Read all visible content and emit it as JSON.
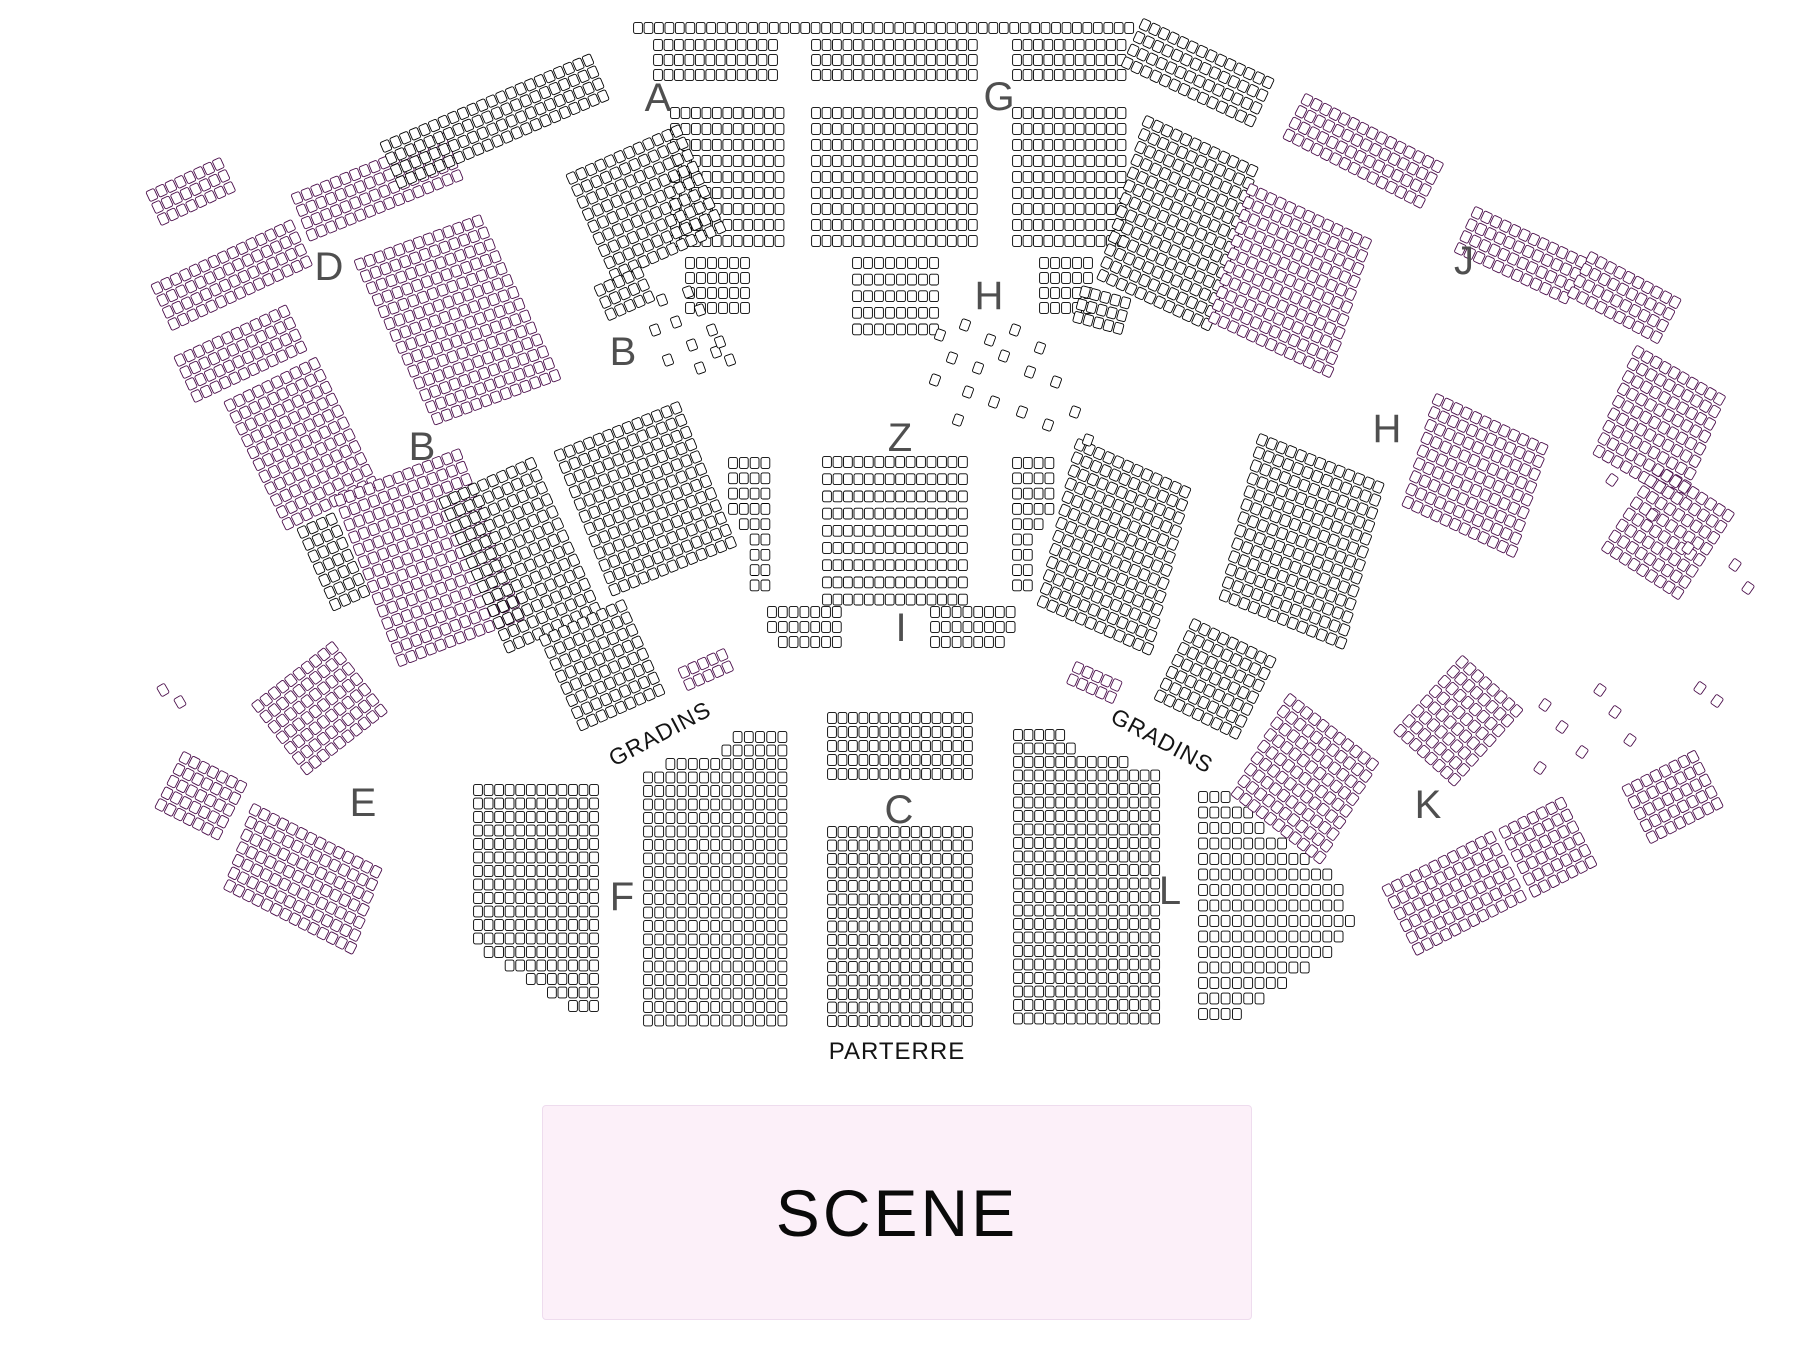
{
  "map": {
    "title": "Seating plan",
    "colors": {
      "background": "#ffffff",
      "seat_fill": "#ffffff",
      "seat_stroke": "#000000",
      "seat_stroke_alt": "#4a0d4a",
      "section_label": "#4f4f4f",
      "text": "#141414",
      "stage_bg": "#fcf0f9",
      "stage_border": "#eedcee"
    },
    "seat": {
      "w": 8.8,
      "h": 10.8,
      "rx": 1.8
    },
    "texts": {
      "gradins_left": "GRADINS",
      "gradins_right": "GRADINS",
      "parterre": "PARTERRE"
    },
    "stage": {
      "label": "SCENE"
    },
    "sections": [
      {
        "t": "A",
        "x": 658,
        "y": 98
      },
      {
        "t": "G",
        "x": 999,
        "y": 97
      },
      {
        "t": "D",
        "x": 329,
        "y": 267
      },
      {
        "t": "B",
        "x": 623,
        "y": 352
      },
      {
        "t": "B",
        "x": 422,
        "y": 447
      },
      {
        "t": "H",
        "x": 989,
        "y": 296
      },
      {
        "t": "J",
        "x": 1464,
        "y": 261
      },
      {
        "t": "H",
        "x": 1387,
        "y": 429
      },
      {
        "t": "Z",
        "x": 900,
        "y": 438
      },
      {
        "t": "I",
        "x": 901,
        "y": 628
      },
      {
        "t": "E",
        "x": 363,
        "y": 803
      },
      {
        "t": "K",
        "x": 1428,
        "y": 805
      },
      {
        "t": "F",
        "x": 622,
        "y": 897
      },
      {
        "t": "C",
        "x": 899,
        "y": 810
      },
      {
        "t": "L",
        "x": 1170,
        "y": 891
      }
    ],
    "blocks": [
      {
        "n": "top-row",
        "x": 638,
        "y": 28,
        "c": 48,
        "r": 1,
        "rp": 16
      },
      {
        "n": "upper-left",
        "x": 658,
        "y": 45,
        "c": 12,
        "r": 3,
        "rp": 15
      },
      {
        "n": "upper-center",
        "x": 816,
        "y": 45,
        "c": 16,
        "r": 3,
        "rp": 15
      },
      {
        "n": "upper-right",
        "x": 1017,
        "y": 45,
        "c": 11,
        "r": 3,
        "rp": 15
      },
      {
        "n": "A-main",
        "x": 675,
        "y": 113,
        "c": 11,
        "r": 9,
        "rp": 16
      },
      {
        "n": "G-main",
        "x": 816,
        "y": 113,
        "c": 16,
        "r": 9,
        "rp": 16
      },
      {
        "n": "G-right",
        "x": 1017,
        "y": 113,
        "c": 11,
        "r": 9,
        "rp": 16
      },
      {
        "n": "H-center",
        "x": 857,
        "y": 263,
        "c": 8,
        "r": 5,
        "rp": 16.6,
        "cp": 11
      },
      {
        "n": "H-left-tail",
        "x": 690,
        "y": 263,
        "c": 6,
        "r": 4,
        "rp": 15,
        "cp": 11
      },
      {
        "n": "H-right-tail",
        "x": 1044,
        "y": 263,
        "c": 5,
        "r": 4,
        "rp": 15,
        "cp": 11
      },
      {
        "n": "Z-main",
        "x": 827,
        "y": 462,
        "c": 14,
        "r": 9,
        "rp": 17.2
      },
      {
        "n": "Z-left-flank",
        "x": 733,
        "y": 463,
        "rp": 15.3,
        "cp": 10.8,
        "spec": [
          [
            0,
            4
          ],
          [
            0,
            4
          ],
          [
            0,
            4
          ],
          [
            0,
            4
          ],
          [
            1,
            3
          ],
          [
            2,
            2
          ],
          [
            2,
            2
          ],
          [
            2,
            2
          ],
          [
            2,
            2
          ]
        ]
      },
      {
        "n": "Z-right-flank",
        "x": 1017,
        "y": 463,
        "rp": 15.3,
        "cp": 10.8,
        "spec": [
          [
            0,
            4
          ],
          [
            0,
            4
          ],
          [
            0,
            4
          ],
          [
            0,
            4
          ],
          [
            0,
            3
          ],
          [
            0,
            2
          ],
          [
            0,
            2
          ],
          [
            0,
            2
          ],
          [
            0,
            2
          ]
        ]
      },
      {
        "n": "I-left",
        "x": 772,
        "y": 612,
        "rp": 15,
        "cp": 10.8,
        "spec": [
          [
            0,
            7
          ],
          [
            0,
            7
          ],
          [
            1,
            6
          ]
        ]
      },
      {
        "n": "I-right",
        "x": 935,
        "y": 612,
        "rp": 15,
        "cp": 10.8,
        "spec": [
          [
            0,
            8
          ],
          [
            0,
            8
          ],
          [
            0,
            7
          ]
        ]
      },
      {
        "n": "C-upper",
        "x": 832,
        "y": 718,
        "c": 14,
        "r": 5,
        "rp": 14
      },
      {
        "n": "C-lower",
        "x": 832,
        "y": 832,
        "c": 14,
        "r": 15,
        "rp": 13.5
      },
      {
        "n": "F-main",
        "x": 648,
        "y": 737,
        "cp": 11.2,
        "rp": 13.5,
        "spec": [
          [
            8,
            5
          ],
          [
            7,
            6
          ],
          [
            2,
            11
          ],
          [
            0,
            13
          ],
          [
            0,
            13
          ],
          [
            0,
            13
          ],
          [
            0,
            13
          ],
          [
            0,
            13
          ],
          [
            0,
            13
          ],
          [
            0,
            13
          ],
          [
            0,
            13
          ],
          [
            0,
            13
          ],
          [
            0,
            13
          ],
          [
            0,
            13
          ],
          [
            0,
            13
          ],
          [
            0,
            13
          ],
          [
            0,
            13
          ],
          [
            0,
            13
          ],
          [
            0,
            13
          ],
          [
            0,
            13
          ],
          [
            0,
            13
          ],
          [
            0,
            13
          ]
        ]
      },
      {
        "n": "L-main",
        "x": 1018,
        "y": 735,
        "cp": 10.55,
        "rp": 13.5,
        "spec": [
          [
            0,
            5
          ],
          [
            0,
            6
          ],
          [
            0,
            11
          ],
          [
            0,
            14
          ],
          [
            0,
            14
          ],
          [
            0,
            14
          ],
          [
            0,
            14
          ],
          [
            0,
            14
          ],
          [
            0,
            14
          ],
          [
            0,
            14
          ],
          [
            0,
            14
          ],
          [
            0,
            14
          ],
          [
            0,
            14
          ],
          [
            0,
            14
          ],
          [
            0,
            14
          ],
          [
            0,
            14
          ],
          [
            0,
            14
          ],
          [
            0,
            14
          ],
          [
            0,
            14
          ],
          [
            0,
            14
          ],
          [
            0,
            14
          ],
          [
            0,
            14
          ]
        ]
      },
      {
        "n": "F-outer",
        "x": 478,
        "y": 790,
        "cp": 10.55,
        "rp": 13.5,
        "spec": [
          [
            0,
            12
          ],
          [
            0,
            12
          ],
          [
            0,
            12
          ],
          [
            0,
            12
          ],
          [
            0,
            12
          ],
          [
            0,
            12
          ],
          [
            0,
            12
          ],
          [
            0,
            12
          ],
          [
            0,
            12
          ],
          [
            0,
            12
          ],
          [
            0,
            12
          ],
          [
            0,
            12
          ],
          [
            1,
            11
          ],
          [
            3,
            9
          ],
          [
            5,
            7
          ],
          [
            7,
            5
          ],
          [
            9,
            3
          ]
        ]
      },
      {
        "n": "L-diamond",
        "x": 1203,
        "y": 797,
        "cp": 11.3,
        "rp": 15.5,
        "lens": [
          3,
          5,
          6,
          8,
          10,
          12,
          13,
          13,
          14,
          13,
          12,
          10,
          8,
          6,
          4
        ]
      },
      {
        "n": "dm",
        "x": 152,
        "y": 195,
        "rot": -25,
        "c": 8,
        "r": 3,
        "tint": "p"
      },
      {
        "n": "d1",
        "x": 157,
        "y": 288,
        "rot": -25,
        "c": 15,
        "r": 4,
        "tint": "p"
      },
      {
        "n": "d2",
        "x": 297,
        "y": 198,
        "rot": -22,
        "c": 16,
        "r": 4,
        "tint": "p"
      },
      {
        "n": "d4",
        "x": 180,
        "y": 360,
        "rot": -25,
        "c": 12,
        "r": 4,
        "tint": "p"
      },
      {
        "n": "d5",
        "x": 230,
        "y": 405,
        "rot": -26,
        "c": 10,
        "r": 11,
        "tint": "p"
      },
      {
        "n": "d3",
        "x": 360,
        "y": 264,
        "rot": -20,
        "c": 13,
        "r": 14,
        "sh": 1.5,
        "tint": "p"
      },
      {
        "n": "a1",
        "x": 386,
        "y": 146,
        "rot": -23,
        "c": 22,
        "r": 4,
        "rp": 13
      },
      {
        "n": "a2",
        "x": 572,
        "y": 178,
        "rot": -24,
        "c": 12,
        "r": 9
      },
      {
        "n": "a3",
        "x": 600,
        "y": 290,
        "rot": -24,
        "c": 5,
        "r": 3
      },
      {
        "n": "ar3",
        "x": 1085,
        "y": 292,
        "rot": 15,
        "c": 5,
        "r": 3
      },
      {
        "n": "b1",
        "x": 340,
        "y": 500,
        "rot": -21,
        "c": 13,
        "r": 14,
        "tint": "p"
      },
      {
        "n": "b-mid",
        "x": 560,
        "y": 455,
        "rot": -22,
        "c": 13,
        "r": 12
      },
      {
        "n": "be1",
        "x": 445,
        "y": 502,
        "rot": -24,
        "c": 10,
        "r": 13
      },
      {
        "n": "be2",
        "x": 303,
        "y": 532,
        "rot": -24,
        "c": 4,
        "r": 7
      },
      {
        "n": "b2",
        "x": 258,
        "y": 706,
        "rot": -38,
        "c": 10,
        "r": 7,
        "tint": "p"
      },
      {
        "n": "gl",
        "x": 545,
        "y": 640,
        "rot": -24,
        "c": 9,
        "r": 8
      },
      {
        "n": "glt",
        "x": 684,
        "y": 672,
        "rot": -24,
        "c": 5,
        "r": 2,
        "tint": "p"
      },
      {
        "n": "grt",
        "x": 1078,
        "y": 668,
        "rot": 24,
        "c": 5,
        "r": 2,
        "tint": "p"
      },
      {
        "n": "e1",
        "x": 185,
        "y": 758,
        "rot": 27,
        "c": 7,
        "r": 5,
        "tint": "p"
      },
      {
        "n": "e2",
        "x": 255,
        "y": 810,
        "rot": 27,
        "c": 14,
        "r": 7,
        "sh": 2,
        "tint": "p"
      },
      {
        "n": "lr1",
        "x": 1080,
        "y": 445,
        "rot": 24,
        "c": 12,
        "r": 13,
        "sh": 2.5
      },
      {
        "n": "gr",
        "x": 1195,
        "y": 625,
        "rot": 26,
        "c": 9,
        "r": 7
      },
      {
        "n": "ja",
        "x": 1145,
        "y": 25,
        "rot": 25,
        "c": 14,
        "r": 4,
        "rp": 14
      },
      {
        "n": "jm1",
        "x": 1148,
        "y": 122,
        "rot": 25,
        "c": 12,
        "r": 13,
        "sh": 2
      },
      {
        "n": "jm2",
        "x": 1252,
        "y": 190,
        "rot": 25,
        "c": 13,
        "r": 11,
        "sh": 2,
        "tint": "p"
      },
      {
        "n": "j1",
        "x": 1307,
        "y": 100,
        "rot": 27,
        "c": 15,
        "r": 4,
        "tint": "p"
      },
      {
        "n": "j2",
        "x": 1477,
        "y": 213,
        "rot": 25,
        "c": 12,
        "r": 4,
        "tint": "p"
      },
      {
        "n": "j3",
        "x": 1592,
        "y": 258,
        "rot": 28,
        "c": 10,
        "r": 4,
        "tint": "p"
      },
      {
        "n": "fr1",
        "x": 1638,
        "y": 352,
        "rot": 30,
        "c": 10,
        "r": 9,
        "sh": 2,
        "tint": "p"
      },
      {
        "n": "fr2",
        "x": 1658,
        "y": 470,
        "rot": 33,
        "c": 9,
        "r": 8,
        "tint": "p"
      },
      {
        "n": "hr1",
        "x": 1262,
        "y": 440,
        "rot": 22,
        "c": 13,
        "r": 13,
        "sh": 2
      },
      {
        "n": "hr2",
        "x": 1438,
        "y": 400,
        "rot": 25,
        "c": 12,
        "r": 9,
        "sh": 2,
        "tint": "p"
      },
      {
        "n": "kr-mid",
        "x": 1290,
        "y": 700,
        "rot": 38,
        "c": 11,
        "r": 9,
        "sh": 2,
        "tint": "p"
      },
      {
        "n": "k-fan",
        "x": 1462,
        "y": 662,
        "rot": 42,
        "c": 8,
        "r": 8,
        "tint": "p"
      },
      {
        "n": "k2a",
        "x": 1388,
        "y": 890,
        "rot": -27,
        "c": 12,
        "r": 6,
        "tint": "p"
      },
      {
        "n": "k2b",
        "x": 1505,
        "y": 832,
        "rot": -27,
        "c": 7,
        "r": 6,
        "tint": "p"
      },
      {
        "n": "k1o",
        "x": 1628,
        "y": 790,
        "rot": -27,
        "c": 8,
        "r": 5,
        "tint": "p"
      }
    ],
    "scatter": [
      {
        "x": 662,
        "y": 300,
        "rot": -20
      },
      {
        "x": 688,
        "y": 292,
        "rot": -20
      },
      {
        "x": 700,
        "y": 310,
        "rot": -20
      },
      {
        "x": 676,
        "y": 322,
        "rot": -20
      },
      {
        "x": 712,
        "y": 330,
        "rot": -20
      },
      {
        "x": 692,
        "y": 345,
        "rot": -20
      },
      {
        "x": 716,
        "y": 352,
        "rot": -20
      },
      {
        "x": 668,
        "y": 360,
        "rot": -20
      },
      {
        "x": 700,
        "y": 368,
        "rot": -20
      },
      {
        "x": 720,
        "y": 342,
        "rot": -20
      },
      {
        "x": 655,
        "y": 330,
        "rot": -20
      },
      {
        "x": 730,
        "y": 360,
        "rot": -20
      },
      {
        "x": 940,
        "y": 335,
        "rot": 20
      },
      {
        "x": 965,
        "y": 325,
        "rot": 20
      },
      {
        "x": 990,
        "y": 340,
        "rot": 20
      },
      {
        "x": 1015,
        "y": 330,
        "rot": 20
      },
      {
        "x": 1040,
        "y": 348,
        "rot": 20
      },
      {
        "x": 952,
        "y": 358,
        "rot": 20
      },
      {
        "x": 978,
        "y": 368,
        "rot": 20
      },
      {
        "x": 1004,
        "y": 356,
        "rot": 20
      },
      {
        "x": 1030,
        "y": 372,
        "rot": 20
      },
      {
        "x": 1056,
        "y": 382,
        "rot": 20
      },
      {
        "x": 968,
        "y": 392,
        "rot": 20
      },
      {
        "x": 994,
        "y": 402,
        "rot": 20
      },
      {
        "x": 1022,
        "y": 412,
        "rot": 20
      },
      {
        "x": 1048,
        "y": 425,
        "rot": 20
      },
      {
        "x": 1075,
        "y": 412,
        "rot": 20
      },
      {
        "x": 1088,
        "y": 440,
        "rot": 20
      },
      {
        "x": 958,
        "y": 420,
        "rot": 20
      },
      {
        "x": 935,
        "y": 380,
        "rot": 20
      },
      {
        "x": 1545,
        "y": 705,
        "rot": 35,
        "t": "p"
      },
      {
        "x": 1562,
        "y": 727,
        "rot": 35,
        "t": "p"
      },
      {
        "x": 1582,
        "y": 752,
        "rot": 35,
        "t": "p"
      },
      {
        "x": 1540,
        "y": 768,
        "rot": 35,
        "t": "p"
      },
      {
        "x": 1600,
        "y": 690,
        "rot": 35,
        "t": "p"
      },
      {
        "x": 1615,
        "y": 712,
        "rot": 35,
        "t": "p"
      },
      {
        "x": 1630,
        "y": 740,
        "rot": 35,
        "t": "p"
      },
      {
        "x": 1700,
        "y": 688,
        "rot": 35,
        "t": "p"
      },
      {
        "x": 1717,
        "y": 701,
        "rot": 35,
        "t": "p"
      },
      {
        "x": 1735,
        "y": 565,
        "rot": 35,
        "t": "p"
      },
      {
        "x": 1748,
        "y": 588,
        "rot": 35,
        "t": "p"
      },
      {
        "x": 1612,
        "y": 480,
        "rot": 35,
        "t": "p"
      },
      {
        "x": 1652,
        "y": 515,
        "rot": 35,
        "t": "p"
      },
      {
        "x": 1688,
        "y": 548,
        "rot": 35,
        "t": "p"
      },
      {
        "x": 163,
        "y": 690,
        "rot": -30,
        "t": "p"
      },
      {
        "x": 180,
        "y": 702,
        "rot": -30,
        "t": "p"
      }
    ]
  }
}
